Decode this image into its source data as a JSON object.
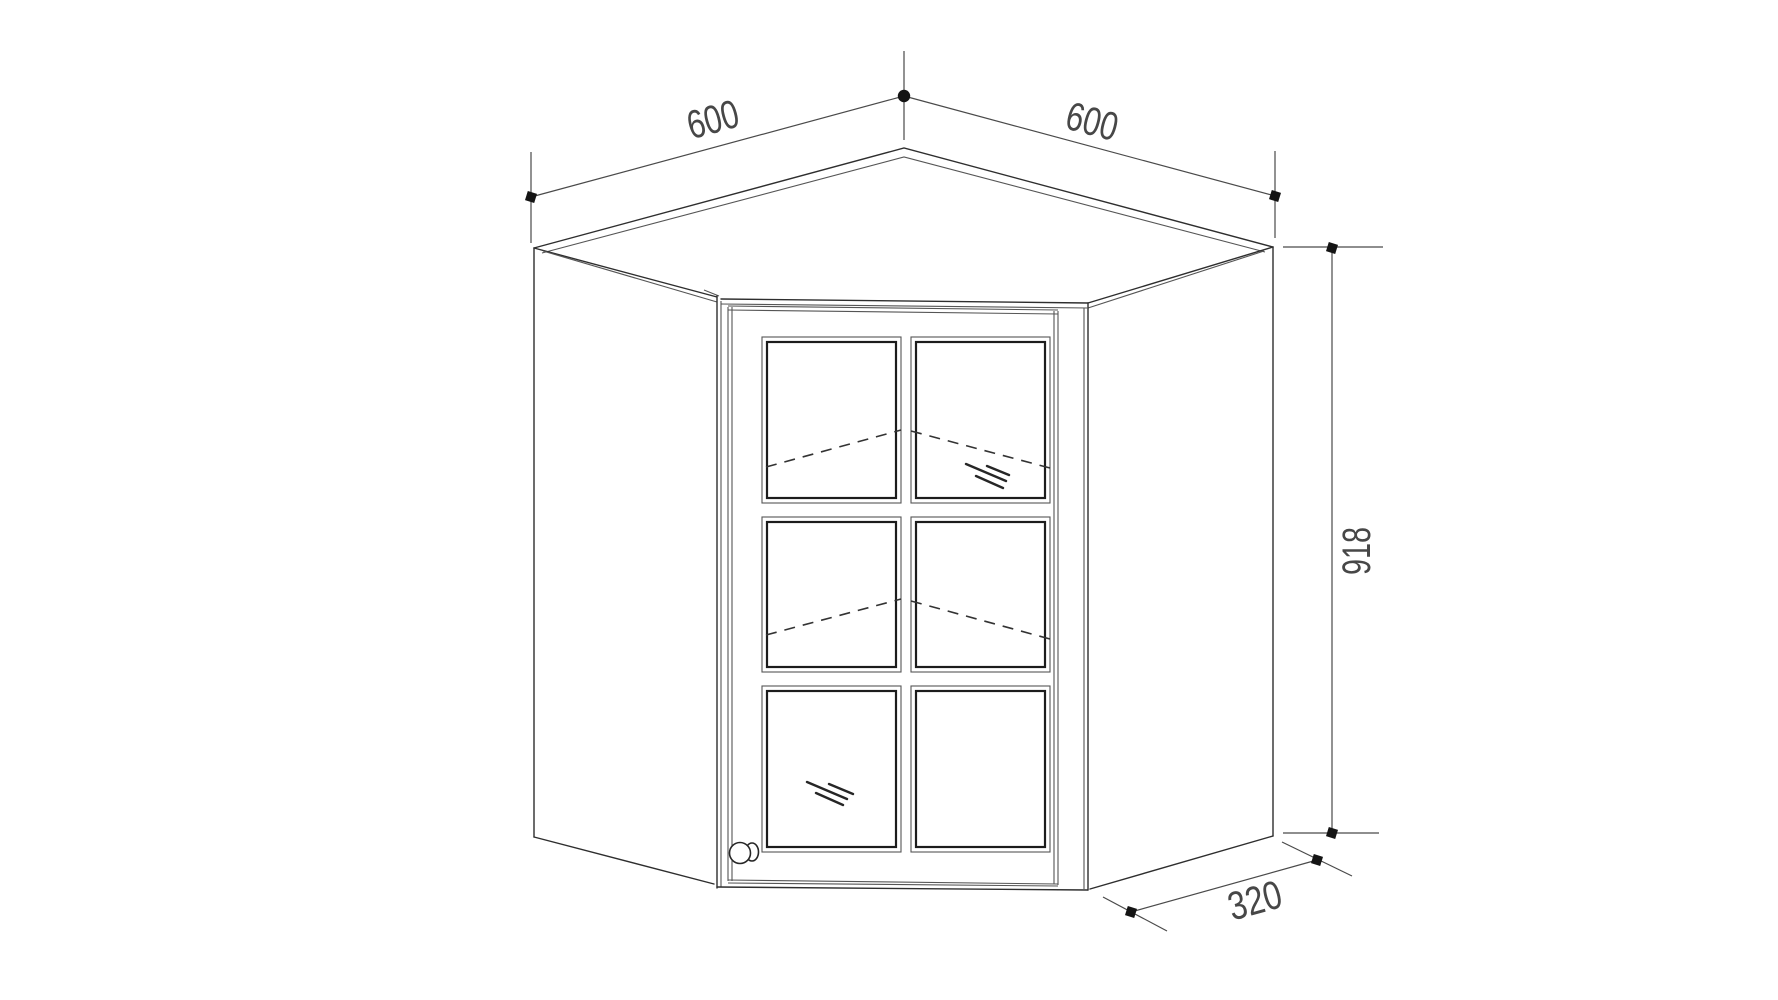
{
  "diagram": {
    "kind": "technical-line-drawing",
    "subject": "corner wall cabinet with six-pane glass door",
    "pane_rows": 3,
    "pane_columns": 2,
    "shelf_lines": 2
  },
  "dimensions": {
    "top_left_width": {
      "label": "600"
    },
    "top_right_width": {
      "label": "600"
    },
    "height": {
      "label": "918"
    },
    "side_depth": {
      "label": "320"
    }
  },
  "style": {
    "background": "#ffffff",
    "outline_color": "#2e2e2e",
    "pane_inner_color": "#1c1c1c",
    "dimension_color": "#4a4a4a",
    "label_color": "#474747",
    "marker_color": "#141414"
  }
}
